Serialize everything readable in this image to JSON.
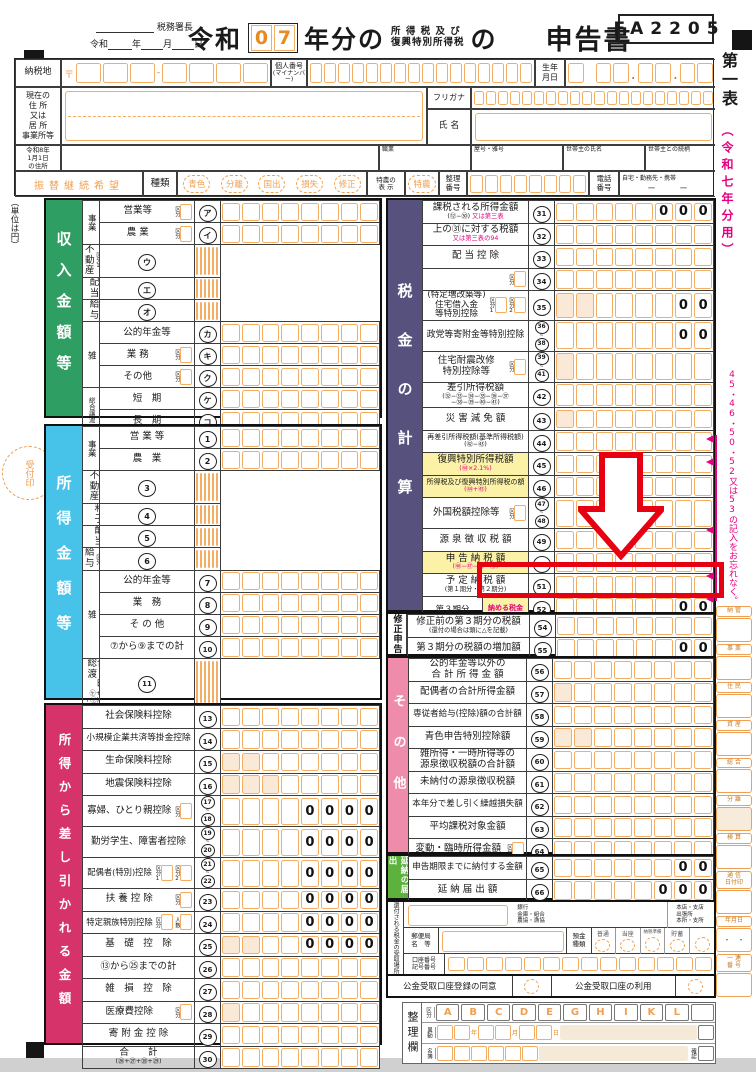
{
  "header": {
    "to_label": "税務署長",
    "date_line": {
      "era": "令和",
      "y": "年",
      "m": "月",
      "d": "日"
    },
    "era_big": "令和",
    "year_digits": [
      "0",
      "7"
    ],
    "nenbun": "年分の",
    "small1": "所 得 税 及 び",
    "small2": "復興特別所得税",
    "no": "の",
    "title": "申告書",
    "form_code": "FA2205"
  },
  "identity": {
    "nouzeichi": "納税地",
    "yubin_mark": "〒",
    "kojin_bango": "個人番号",
    "mynumber": "(マイナンバー)",
    "birth": "生年\n月日",
    "address_label": "現在の\n住 所\n又は\n居 所\n事業所等",
    "furigana": "フリガナ",
    "shimei": "氏 名",
    "reiwa8": "令和8年\n1月1日\nの住所",
    "shokugyo": "職業",
    "yago": "屋号・雅号",
    "setainushi": "世帯主の氏名",
    "tsuzukigara": "世帯主との続柄",
    "furikae": "振替継続希望",
    "shurui": "種類",
    "types": [
      "青色",
      "分離",
      "国出",
      "損失",
      "修正"
    ],
    "tokuno_label": "特農の\n表 示",
    "tokuno": "特農",
    "seiri_bango": "整理\n番号",
    "denwa": "電話\n番号",
    "denwa_note": "自宅・勤務先・携帯",
    "denwa_dash": "ー　　　ー"
  },
  "misc": {
    "unit_note": "（単位は円）",
    "uketsuke": "受付印"
  },
  "sections": {
    "income": {
      "title": "収入金額等",
      "color": "#2f9e62",
      "rows": [
        {
          "g": "事業",
          "gs": 2,
          "l": "営業等",
          "k": [
            "区分"
          ],
          "n": "ア"
        },
        {
          "l": "農 業",
          "k": [
            "区分"
          ],
          "n": "イ"
        },
        {
          "l": "不動産",
          "k": [
            "区分1",
            "区分2"
          ],
          "n": "ウ"
        },
        {
          "l": "配　当",
          "n": "エ"
        },
        {
          "l": "給　与",
          "k": [
            "区分"
          ],
          "n": "オ"
        },
        {
          "g": "雑",
          "gs": 3,
          "l": "公的年金等",
          "n": "カ"
        },
        {
          "l": "業 務",
          "k": [
            "区分"
          ],
          "n": "キ"
        },
        {
          "l": "その他",
          "k": [
            "区分"
          ],
          "n": "ク"
        },
        {
          "g": "総合譲渡",
          "gs": 2,
          "l": "短　期",
          "n": "ケ"
        },
        {
          "l": "長　期",
          "n": "コ"
        },
        {
          "l": "一　時",
          "n": "サ"
        }
      ]
    },
    "shotoku": {
      "title": "所得金額等",
      "color": "#47c2e8",
      "rows": [
        {
          "g": "事業",
          "gs": 2,
          "l": "営 業 等",
          "n": "1"
        },
        {
          "l": "農　業",
          "n": "2"
        },
        {
          "l": "不　動　産",
          "n": "3"
        },
        {
          "l": "利　　子",
          "n": "4"
        },
        {
          "l": "配　　当",
          "n": "5"
        },
        {
          "l": "給与",
          "k": [
            "区分"
          ],
          "n": "6"
        },
        {
          "g": "雑",
          "gs": 4,
          "l": "公的年金等",
          "n": "7"
        },
        {
          "l": "業　務",
          "n": "8"
        },
        {
          "l": "そ の 他",
          "n": "9"
        },
        {
          "l": "⑦から⑨までの計",
          "n": "10"
        },
        {
          "l": "総合譲渡・一時",
          "s": "㋘+{(㋙+㋚)×1/2}",
          "n": "11"
        },
        {
          "l": "合　　計",
          "s": "(①から⑥までの計+⑩+⑪)",
          "n": "12"
        }
      ]
    },
    "deduct": {
      "title": "所得から差し引かれる金額",
      "color": "#d6336b",
      "rows": [
        {
          "l": "社会保険料控除",
          "n": "13"
        },
        {
          "l": "小規模企業共済等掛金控除",
          "n": "14"
        },
        {
          "l": "生命保険料控除",
          "n": "15",
          "shade": 2
        },
        {
          "l": "地震保険料控除",
          "n": "16",
          "shade": 3
        },
        {
          "l": "寡婦、ひとり親控除",
          "k": [
            "区分"
          ],
          "nr": [
            "17",
            "18"
          ],
          "z": "0000"
        },
        {
          "l": "勤労学生、障害者控除",
          "nr": [
            "19",
            "20"
          ],
          "z": "0000"
        },
        {
          "l": "配偶者(特別)控除",
          "k": [
            "区分1",
            "区分2"
          ],
          "nr": [
            "21",
            "22"
          ],
          "z": "0000"
        },
        {
          "l": "扶 養 控 除",
          "k": [
            "区分"
          ],
          "n": "23",
          "z": "0000"
        },
        {
          "l": "特定親族特別控除",
          "k": [
            "区分",
            "人数"
          ],
          "n": "24",
          "z": "0000"
        },
        {
          "l": "基　礎　控　除",
          "n": "25",
          "z": "0000",
          "shade": 2
        },
        {
          "l": "⑬から㉕までの計",
          "n": "26"
        },
        {
          "l": "雑　損　控　除",
          "n": "27"
        },
        {
          "l": "医療費控除",
          "k": [
            "区分"
          ],
          "n": "28",
          "shade": 1
        },
        {
          "l": "寄 附 金 控 除",
          "n": "29"
        },
        {
          "l": "合　　計",
          "s": "(㉖+㉗+㉘+㉙)",
          "n": "30"
        }
      ]
    },
    "tax": {
      "title": "税金の計算",
      "color": "#57517e",
      "rows": [
        {
          "l": "課税される所得金額",
          "s": "(⑫−㉚)",
          "s2": "又は第三表",
          "n": "31",
          "z": "000"
        },
        {
          "l": "上の㉛に対する税額",
          "s2": "又は第三表の94",
          "n": "32"
        },
        {
          "l": "配 当 控 除",
          "n": "33"
        },
        {
          "l": "",
          "k": [
            "区分"
          ],
          "n": "34"
        },
        {
          "l": "(特定増改築等)\n住宅借入金\n等特別控除",
          "k": [
            "区分1",
            "区分2"
          ],
          "n": "35",
          "z": "00",
          "shade": 2
        },
        {
          "l": "政党等寄附金等特別控除",
          "nr": [
            "36",
            "38"
          ],
          "z": "00"
        },
        {
          "l": "住宅耐震改修\n特別控除等",
          "k": [
            "区分"
          ],
          "nr": [
            "39",
            "41"
          ],
          "shade": 1
        },
        {
          "l": "差引所得税額",
          "s": "(㉜−㉝−㉞−㉟−㊱−㊲\n−㊳−㊴−㊵−㊶)",
          "n": "42"
        },
        {
          "l": "災 害 減 免 額",
          "n": "43",
          "shade": 1
        },
        {
          "l": "再差引所得税額(基準所得税額)",
          "s": "(㊷−㊸)",
          "n": "44"
        },
        {
          "l": "復興特別所得税額",
          "s2": "(㊹×2.1%)",
          "n": "45",
          "yellow": 1
        },
        {
          "l": "所得税及び復興特別所得税の額",
          "s2": "(㊹+㊺)",
          "n": "46",
          "yellow": 1
        },
        {
          "l": "外国税額控除等",
          "k": [
            "区分"
          ],
          "nr": [
            "47",
            "48"
          ]
        },
        {
          "l": "源 泉 徴 収 税 額",
          "n": "49"
        },
        {
          "l": "申 告 納 税 額",
          "s2": "(㊻−㊼−㊽−㊾)",
          "n": "50",
          "yellow": 1
        },
        {
          "l": "予 定 納 税 額",
          "s": "(第１期分・第２期分)",
          "n": "51"
        },
        {
          "l3": "第３期分\nの 税 額",
          "l3p": "(㊿−51)",
          "sub": "納める税金",
          "n": "52",
          "z": "00",
          "red": 1
        },
        {
          "cov3": 1,
          "sub": "還付される税金",
          "n": "53",
          "tri": 1
        }
      ]
    },
    "correction": {
      "title": "修正申告",
      "color": "#ffffff",
      "fg": "#111111",
      "rows": [
        {
          "l": "修正前の第３期分の税額",
          "s": "(還付の場合は頭に△を記載)",
          "n": "54"
        },
        {
          "l": "第３期分の税額の増加額",
          "n": "55",
          "z": "00"
        }
      ]
    },
    "other": {
      "title": "その他",
      "color": "#f08cab",
      "rows": [
        {
          "l": "公的年金等以外の\n合 計 所 得 金 額",
          "n": "56"
        },
        {
          "l": "配偶者の合計所得金額",
          "n": "57",
          "shade": 1
        },
        {
          "l": "専従者給与(控除)額の合計額",
          "n": "58"
        },
        {
          "l": "青色申告特別控除額",
          "n": "59",
          "shade": 2
        },
        {
          "l": "雑所得・一時所得等の\n源泉徴収税額の合計額",
          "n": "60"
        },
        {
          "l": "未納付の源泉徴収税額",
          "n": "61"
        },
        {
          "l": "本年分で差し引く繰越損失額",
          "n": "62"
        },
        {
          "l": "平均課税対象金額",
          "n": "63"
        },
        {
          "l": "変動・臨時所得金額",
          "k": [
            "区分"
          ],
          "n": "64"
        }
      ]
    },
    "postpone": {
      "title": "延納の届出",
      "color": "#5cb23d",
      "rows": [
        {
          "l": "申告期限までに納付する金額",
          "n": "65",
          "z": "00"
        },
        {
          "l": "延 納 届 出 額",
          "n": "66",
          "z": "000"
        }
      ]
    }
  },
  "refund": {
    "side_label": "還付される税金の受取場所",
    "bank_words": "銀行\n金庫・組合\n農協・漁協",
    "branch_words": "本店・支店\n出張所\n本所・支所",
    "post_label": "郵便局\n名　等",
    "deposit_label": "預金\n種類",
    "deposit_types": [
      "普通",
      "当座",
      "納税準備",
      "貯蓄",
      ""
    ],
    "account_label": "口座番号\n記号番号"
  },
  "public_account": {
    "consent": "公金受取口座登録の同意",
    "use": "公金受取口座の利用"
  },
  "seiri": {
    "title": "整理欄",
    "kubun": "区分",
    "ido": "異動",
    "meibo": "名簿",
    "kakunin": "確認",
    "letters": [
      "A",
      "B",
      "C",
      "D",
      "E",
      "G",
      "H",
      "I",
      "K",
      "L"
    ],
    "date_caps": [
      "年",
      "月",
      "日"
    ]
  },
  "right_margin": {
    "sheet": "第一表",
    "year_note": "（令和七年分用）",
    "reminder": "45・46・50・52又は53の記入をお忘れなく。",
    "stamps": [
      {
        "l": "納 管"
      },
      {
        "l": "事 業"
      },
      {
        "l": "住 民"
      },
      {
        "l": "資 産"
      },
      {
        "l": "総 合"
      },
      {
        "l": "分 離",
        "shade": 1
      },
      {
        "l": "検 算"
      },
      {
        "l": "通 信\n日付印"
      },
      {
        "l": "年月日",
        "dots": "・　・"
      },
      {
        "l": "一 連\n番 号"
      }
    ]
  },
  "annotations": {
    "red_arrow_target_row": "52",
    "highlighted_label": "納める税金"
  }
}
